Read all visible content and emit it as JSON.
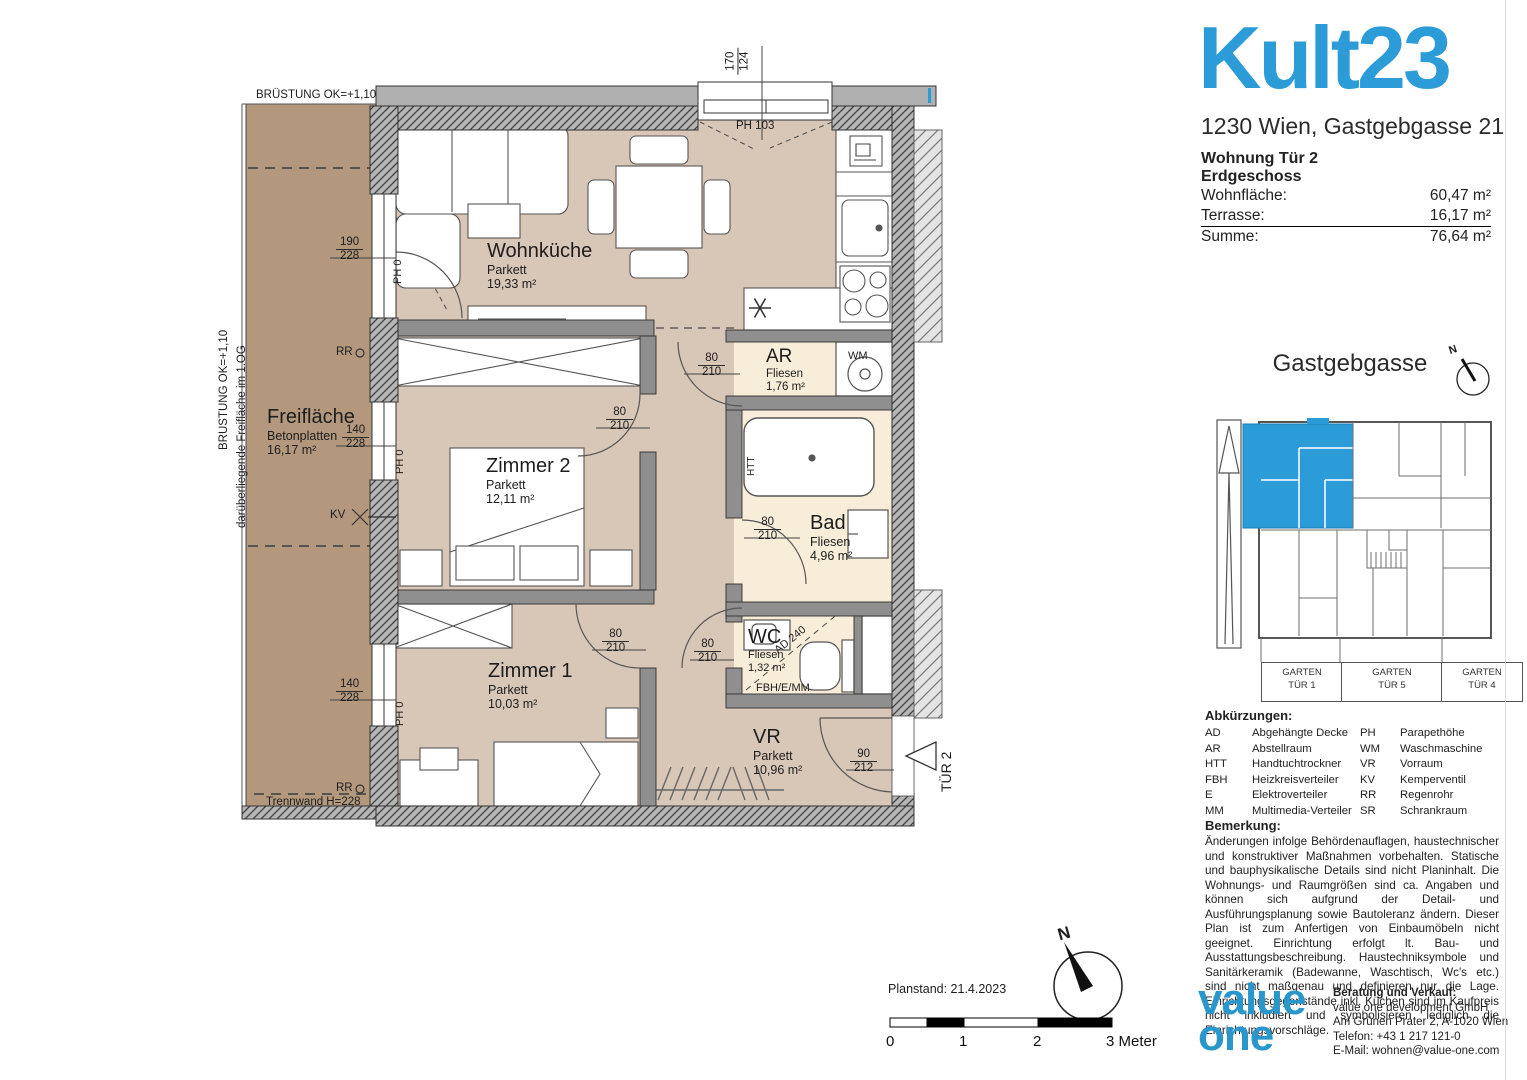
{
  "accent_blue": "#2b9cd8",
  "header": {
    "logo": "Kult23",
    "address": "1230 Wien, Gastgebgasse 21"
  },
  "unit_info": {
    "title": "Wohnung Tür 2",
    "floor": "Erdgeschoss",
    "rows": [
      {
        "label": "Wohnfläche:",
        "value": "60,47 m²"
      },
      {
        "label": "Terrasse:",
        "value": "16,17 m²"
      },
      {
        "label": "Summe:",
        "value": "76,64 m²"
      }
    ]
  },
  "site_plan": {
    "street": "Gastgebgasse",
    "compass_n": "N",
    "garden_boxes": [
      {
        "line1": "GARTEN",
        "line2": "TÜR 1"
      },
      {
        "line1": "GARTEN",
        "line2": "TÜR 5"
      },
      {
        "line1": "GARTEN",
        "line2": "TÜR 4"
      }
    ]
  },
  "abbreviations": {
    "title": "Abkürzungen:",
    "items": [
      {
        "abbr": "AD",
        "term": "Abgehängte Decke"
      },
      {
        "abbr": "AR",
        "term": "Abstellraum"
      },
      {
        "abbr": "HTT",
        "term": "Handtuchtrockner"
      },
      {
        "abbr": "FBH",
        "term": "Heizkreisverteiler"
      },
      {
        "abbr": "E",
        "term": "Elektroverteiler"
      },
      {
        "abbr": "MM",
        "term": "Multimedia-Verteiler"
      },
      {
        "abbr": "PH",
        "term": "Parapethöhe"
      },
      {
        "abbr": "WM",
        "term": "Waschmaschine"
      },
      {
        "abbr": "VR",
        "term": "Vorraum"
      },
      {
        "abbr": "KV",
        "term": "Kemperventil"
      },
      {
        "abbr": "RR",
        "term": "Regenrohr"
      },
      {
        "abbr": "SR",
        "term": "Schrankraum"
      }
    ]
  },
  "remark": {
    "title": "Bemerkung:",
    "text": "Änderungen infolge Behördenauflagen, haustechnischer und konstruktiver Maßnahmen vorbehalten. Statische und bauphysikalische Details sind nicht Planinhalt. Die Wohnungs- und Raumgrößen sind ca. Angaben und können sich aufgrund der Detail- und Ausführungsplanung sowie Bautoleranz ändern. Dieser Plan ist zum Anfertigen von Einbaumöbeln nicht geeignet. Einrichtung erfolgt lt. Bau- und Ausstattungsbeschreibung. Haustechniksymbole und Sanitärkeramik (Badewanne, Waschtisch, Wc's etc.) sind nicht maßgenau und definieren nur die Lage. Einrichtungsgegenstände inkl. Küchen sind im Kaufpreis nicht inkludiert und symbolisieren lediglich die Einrichtungsvorschläge."
  },
  "contact": {
    "logo_line1": "value",
    "logo_line2": "one",
    "title": "Beratung und Verkauf:",
    "company": "value one development GmbH",
    "address": "Am Grünen Prater 2, A-1020 Wien",
    "phone": "Telefon: +43 1 217 121-0",
    "email": "E-Mail:  wohnen@value-one.com"
  },
  "footer_plan": {
    "planstand": "Planstand:  21.4.2023",
    "scale_ticks": [
      "0",
      "1",
      "2"
    ],
    "scale_end": "3 Meter",
    "compass_n": "N"
  },
  "floor_plan": {
    "rooms": [
      {
        "name": "Wohnküche",
        "floor": "Parkett",
        "area": "19,33 m²"
      },
      {
        "name": "Zimmer 2",
        "floor": "Parkett",
        "area": "12,11 m²"
      },
      {
        "name": "Zimmer 1",
        "floor": "Parkett",
        "area": "10,03 m²"
      },
      {
        "name": "Freifläche",
        "floor": "Betonplatten",
        "area": "16,17 m²"
      },
      {
        "name": "AR",
        "floor": "Fliesen",
        "area": "1,76 m²"
      },
      {
        "name": "Bad",
        "floor": "Fliesen",
        "area": "4,96 m²"
      },
      {
        "name": "WC",
        "floor": "Fliesen",
        "area": "1,32 m²"
      },
      {
        "name": "VR",
        "floor": "Parkett",
        "area": "10,96 m²"
      }
    ],
    "dimensions": [
      {
        "top": "190",
        "bottom": "228"
      },
      {
        "top": "140",
        "bottom": "228"
      },
      {
        "top": "140",
        "bottom": "228"
      },
      {
        "top": "170",
        "bottom": "124"
      },
      {
        "top": "80",
        "bottom": "210"
      },
      {
        "top": "80",
        "bottom": "210"
      },
      {
        "top": "80",
        "bottom": "210"
      },
      {
        "top": "80",
        "bottom": "210"
      },
      {
        "top": "80",
        "bottom": "210"
      },
      {
        "top": "90",
        "bottom": "212"
      }
    ],
    "annotations": {
      "bruestung_top": "BRÜSTUNG OK=+1,10",
      "bruestung_left": "BRÜSTUNG OK=+1,10",
      "freiflaeche_left": "darüberliegende Freifläche im 1.OG",
      "trennwand": "Trennwand H=228",
      "ph_103": "PH 103",
      "ph_0": "PH 0",
      "rr": "RR",
      "kv": "KV",
      "wm": "WM",
      "htt": "HTT",
      "ad_240": "AD 240",
      "fbh": "FBH/E/MM",
      "tuer_2": "TÜR 2"
    }
  }
}
